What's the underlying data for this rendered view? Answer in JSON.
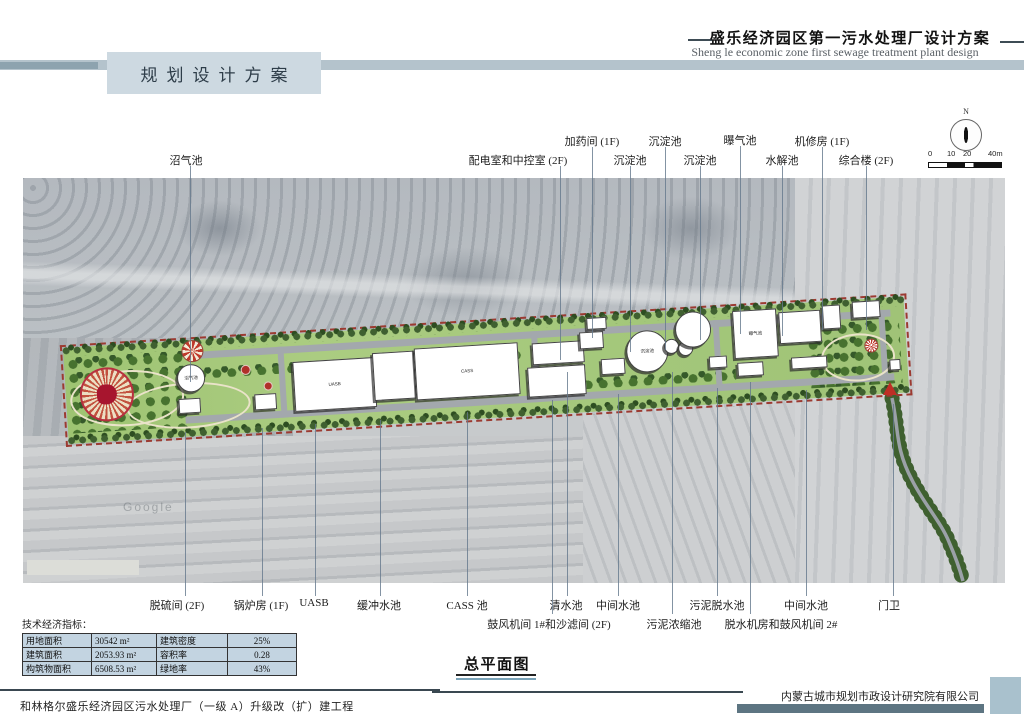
{
  "header": {
    "section_title": "规划设计方案",
    "sheet_title_cn": "盛乐经济园区第一污水处理厂设计方案",
    "sheet_title_en": "Sheng le economic zone first sewage treatment plant design"
  },
  "compass": {
    "north_label": "N"
  },
  "scale_bar": {
    "labels": [
      "0",
      "10",
      "20",
      "40m"
    ]
  },
  "plan": {
    "watermark": "Google",
    "callouts": [
      {
        "text": "加药间 (1F)",
        "tx": 592,
        "ty": 133,
        "lx": 592,
        "ly1": 147,
        "ly2": 338
      },
      {
        "text": "沉淀池",
        "tx": 665,
        "ty": 133,
        "lx": 665,
        "ly1": 147,
        "ly2": 350
      },
      {
        "text": "曝气池",
        "tx": 740,
        "ty": 132,
        "lx": 740,
        "ly1": 146,
        "ly2": 334
      },
      {
        "text": "机修房 (1F)",
        "tx": 822,
        "ty": 133,
        "lx": 822,
        "ly1": 147,
        "ly2": 330
      },
      {
        "text": "沼气池",
        "tx": 186,
        "ty": 152,
        "lx": 190,
        "ly1": 166,
        "ly2": 382
      },
      {
        "text": "配电室和中控室 (2F)",
        "tx": 518,
        "ty": 152,
        "lx": 560,
        "ly1": 166,
        "ly2": 360
      },
      {
        "text": "沉淀池",
        "tx": 630,
        "ty": 152,
        "lx": 630,
        "ly1": 166,
        "ly2": 352
      },
      {
        "text": "沉淀池",
        "tx": 700,
        "ty": 152,
        "lx": 700,
        "ly1": 166,
        "ly2": 340
      },
      {
        "text": "水解池",
        "tx": 782,
        "ty": 152,
        "lx": 782,
        "ly1": 166,
        "ly2": 336
      },
      {
        "text": "综合楼 (2F)",
        "tx": 866,
        "ty": 152,
        "lx": 866,
        "ly1": 166,
        "ly2": 330
      },
      {
        "text": "脱硫间 (2F)",
        "tx": 177,
        "ty": 597,
        "lx": 185,
        "ly1": 432,
        "ly2": 596
      },
      {
        "text": "锅炉房 (1F)",
        "tx": 261,
        "ty": 597,
        "lx": 262,
        "ly1": 428,
        "ly2": 596
      },
      {
        "text": "UASB",
        "tx": 314,
        "ty": 597,
        "lx": 315,
        "ly1": 424,
        "ly2": 596
      },
      {
        "text": "缓冲水池",
        "tx": 379,
        "ty": 597,
        "lx": 380,
        "ly1": 420,
        "ly2": 596
      },
      {
        "text": "CASS 池",
        "tx": 467,
        "ty": 597,
        "lx": 467,
        "ly1": 412,
        "ly2": 596
      },
      {
        "text": "清水池",
        "tx": 566,
        "ty": 597,
        "lx": 567,
        "ly1": 372,
        "ly2": 596
      },
      {
        "text": "中间水池",
        "tx": 618,
        "ty": 597,
        "lx": 618,
        "ly1": 394,
        "ly2": 596
      },
      {
        "text": "污泥脱水池",
        "tx": 717,
        "ty": 597,
        "lx": 717,
        "ly1": 388,
        "ly2": 596
      },
      {
        "text": "中间水池",
        "tx": 806,
        "ty": 597,
        "lx": 806,
        "ly1": 390,
        "ly2": 596
      },
      {
        "text": "门卫",
        "tx": 889,
        "ty": 597,
        "lx": 893,
        "ly1": 404,
        "ly2": 596
      },
      {
        "text": "鼓风机间 1#和沙滤间 (2F)",
        "tx": 549,
        "ty": 616,
        "lx": 552,
        "ly1": 400,
        "ly2": 614
      },
      {
        "text": "污泥浓缩池",
        "tx": 674,
        "ty": 616,
        "lx": 672,
        "ly1": 372,
        "ly2": 614
      },
      {
        "text": "脱水机房和鼓风机间 2#",
        "tx": 781,
        "ty": 616,
        "lx": 750,
        "ly1": 382,
        "ly2": 614
      }
    ],
    "buildings": [
      {
        "name": "central-plaza",
        "shape": "plaza",
        "x": 14,
        "y": 22,
        "d": 50
      },
      {
        "name": "biogas-pond",
        "label": "沼气池",
        "shape": "circle",
        "x": 112,
        "y": 24,
        "d": 26
      },
      {
        "name": "fan-ornament",
        "shape": "fan",
        "x": 118,
        "y": 0,
        "d": 20
      },
      {
        "name": "red-feature-1",
        "shape": "dot",
        "x": 176,
        "y": 28,
        "d": 8
      },
      {
        "name": "red-feature-2",
        "shape": "dot",
        "x": 198,
        "y": 46,
        "d": 7
      },
      {
        "name": "desulfur-room",
        "shape": "rect",
        "x": 112,
        "y": 58,
        "w": 20,
        "h": 13
      },
      {
        "name": "boiler-room",
        "shape": "rect",
        "x": 188,
        "y": 58,
        "w": 20,
        "h": 14
      },
      {
        "name": "uasb-tank",
        "label": "UASB",
        "shape": "rect",
        "x": 228,
        "y": 28,
        "w": 80,
        "h": 48
      },
      {
        "name": "buffer-pool",
        "shape": "rect",
        "x": 308,
        "y": 24,
        "w": 40,
        "h": 46
      },
      {
        "name": "cass-pool",
        "label": "CASS",
        "shape": "rect",
        "x": 350,
        "y": 22,
        "w": 102,
        "h": 50
      },
      {
        "name": "power-control-room",
        "shape": "rect",
        "x": 468,
        "y": 24,
        "w": 50,
        "h": 20
      },
      {
        "name": "blower1-sandfilter",
        "shape": "rect",
        "x": 462,
        "y": 48,
        "w": 56,
        "h": 28
      },
      {
        "name": "dosing-room",
        "shape": "rect",
        "x": 524,
        "y": 2,
        "w": 18,
        "h": 10
      },
      {
        "name": "clear-water-pool",
        "shape": "rect",
        "x": 516,
        "y": 16,
        "w": 22,
        "h": 15
      },
      {
        "name": "mid-water-pool-1",
        "shape": "rect",
        "x": 536,
        "y": 44,
        "w": 22,
        "h": 14
      },
      {
        "name": "sediment-tank-1",
        "label": "沉淀池",
        "shape": "circle",
        "x": 562,
        "y": 18,
        "d": 40
      },
      {
        "name": "sludge-thickener-1",
        "shape": "circle",
        "x": 600,
        "y": 28,
        "d": 13
      },
      {
        "name": "sludge-thickener-2",
        "shape": "circle",
        "x": 614,
        "y": 31,
        "d": 13
      },
      {
        "name": "sediment-tank-2",
        "shape": "circle",
        "x": 612,
        "y": 2,
        "d": 34
      },
      {
        "name": "sludge-dewater-pool",
        "shape": "rect",
        "x": 644,
        "y": 48,
        "w": 16,
        "h": 10
      },
      {
        "name": "dewater-blower2-room",
        "shape": "rect",
        "x": 672,
        "y": 56,
        "w": 24,
        "h": 12
      },
      {
        "name": "aeration-tank",
        "label": "曝气池",
        "shape": "rect",
        "x": 670,
        "y": 4,
        "w": 42,
        "h": 46
      },
      {
        "name": "hydrolysis-tank",
        "shape": "rect",
        "x": 716,
        "y": 8,
        "w": 40,
        "h": 30
      },
      {
        "name": "mid-water-pool-2",
        "shape": "rect",
        "x": 726,
        "y": 54,
        "w": 34,
        "h": 10
      },
      {
        "name": "repair-room",
        "shape": "rect",
        "x": 760,
        "y": 4,
        "w": 16,
        "h": 22
      },
      {
        "name": "complex-building",
        "shape": "rect",
        "x": 790,
        "y": 2,
        "w": 26,
        "h": 15
      },
      {
        "name": "sun-ornament",
        "shape": "sun",
        "x": 800,
        "y": 40,
        "d": 12
      },
      {
        "name": "gatehouse",
        "shape": "rect",
        "x": 824,
        "y": 62,
        "w": 9,
        "h": 9
      }
    ]
  },
  "indicators": {
    "title": "技术经济指标：",
    "rows": [
      [
        "用地面积",
        "30542 m²",
        "建筑密度",
        "25%"
      ],
      [
        "建筑面积",
        "2053.93 m²",
        "容积率",
        "0.28"
      ],
      [
        "构筑物面积",
        "6508.53 m²",
        "绿地率",
        "43%"
      ]
    ]
  },
  "footer": {
    "drawing_name": "总平面图",
    "project_name": "和林格尔盛乐经济园区污水处理厂（一级 A）升级改（扩）建工程",
    "company": "内蒙古城市规划市政设计研究院有限公司"
  },
  "colors": {
    "band": "#b4c3cc",
    "band_accent": "#8da3af",
    "title_box": "#cdd9e1",
    "table_fill": "#c3d4e1",
    "site_green": "#a5c77e",
    "tree_green": "#3f6030",
    "boundary_red": "#9c3a31",
    "bar_slate": "#5d7582",
    "corner_square": "#a9c1cd"
  }
}
